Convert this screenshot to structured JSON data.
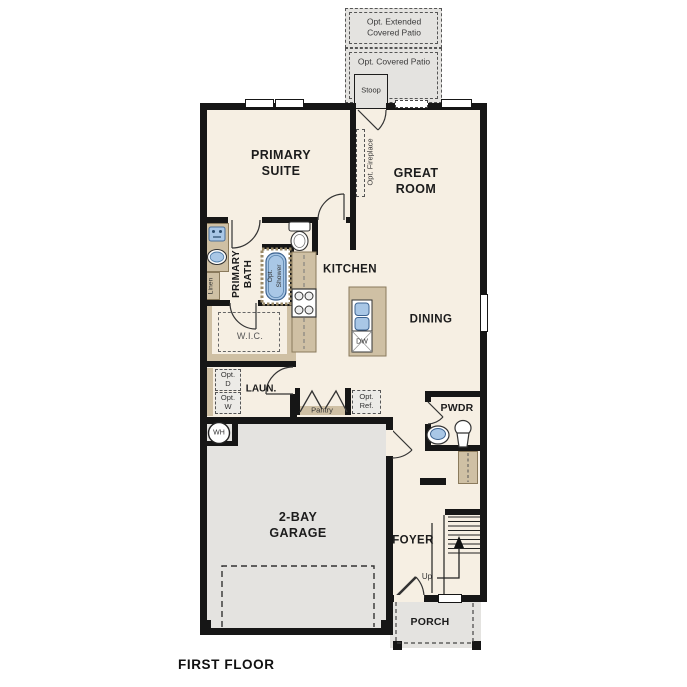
{
  "colors": {
    "floor": "#f6efe3",
    "outdoor": "#e4e3e0",
    "wall": "#161616",
    "cabinet": "#cfc0a4",
    "fixture_blue": "#a9c7e6"
  },
  "title": "FIRST FLOOR",
  "outdoor": {
    "extended_patio": "Opt. Extended\nCovered Patio",
    "covered_patio": "Opt. Covered Patio",
    "stoop": "Stoop",
    "porch": "PORCH"
  },
  "rooms": {
    "primary_suite": "PRIMARY\nSUITE",
    "great_room": "GREAT\nROOM",
    "primary_bath": "PRIMARY\nBATH",
    "kitchen": "KITCHEN",
    "dining": "DINING",
    "wic": "W.I.C.",
    "laundry": "LAUN.",
    "pantry": "Pantry",
    "powder": "PWDR",
    "garage": "2-BAY\nGARAGE",
    "foyer": "FOYER"
  },
  "options": {
    "fireplace": "Opt. Fireplace",
    "shower": "Opt.\nShower",
    "refrigerator": "Opt.\nRef.",
    "dryer": "Opt.\nD",
    "washer": "Opt.\nW"
  },
  "fixtures": {
    "water_heater": "WH",
    "dishwasher": "DW",
    "linen": "Linen",
    "stairs_up": "Up"
  }
}
